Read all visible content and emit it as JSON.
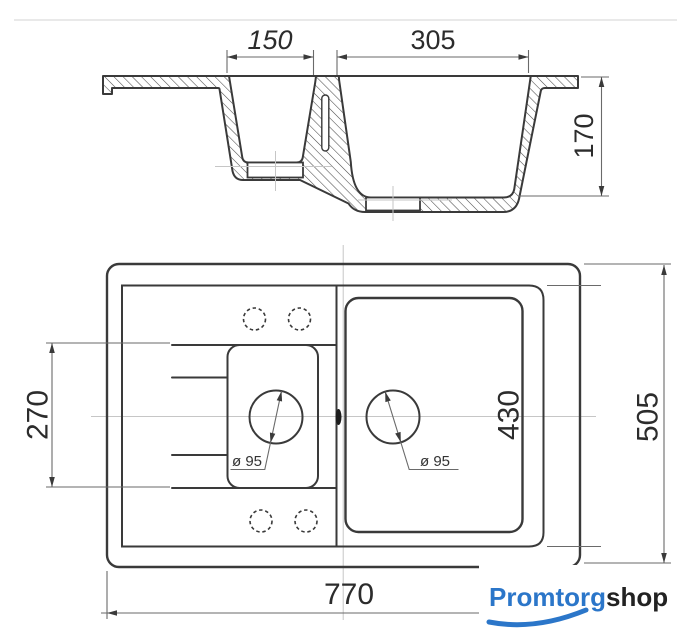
{
  "title": "Double-bowl kitchen sink technical drawing",
  "colors": {
    "background": "#ffffff",
    "line": "#3a3a3a",
    "thin_line": "#6a6a6a",
    "centerline": "#c6c6c6",
    "logo_blue": "#2b76c9",
    "logo_dark": "#222222"
  },
  "cross_section": {
    "width_small_bowl": "150",
    "width_large_bowl": "305",
    "depth": "170"
  },
  "plan_view": {
    "drainboard_length": "270",
    "bowl_length": "430",
    "overall_depth": "505",
    "overall_width": "770",
    "drain_left": "ø 95",
    "drain_right": "ø 95"
  },
  "logo": {
    "brand_primary": "Promtorg",
    "brand_secondary": "shop"
  }
}
